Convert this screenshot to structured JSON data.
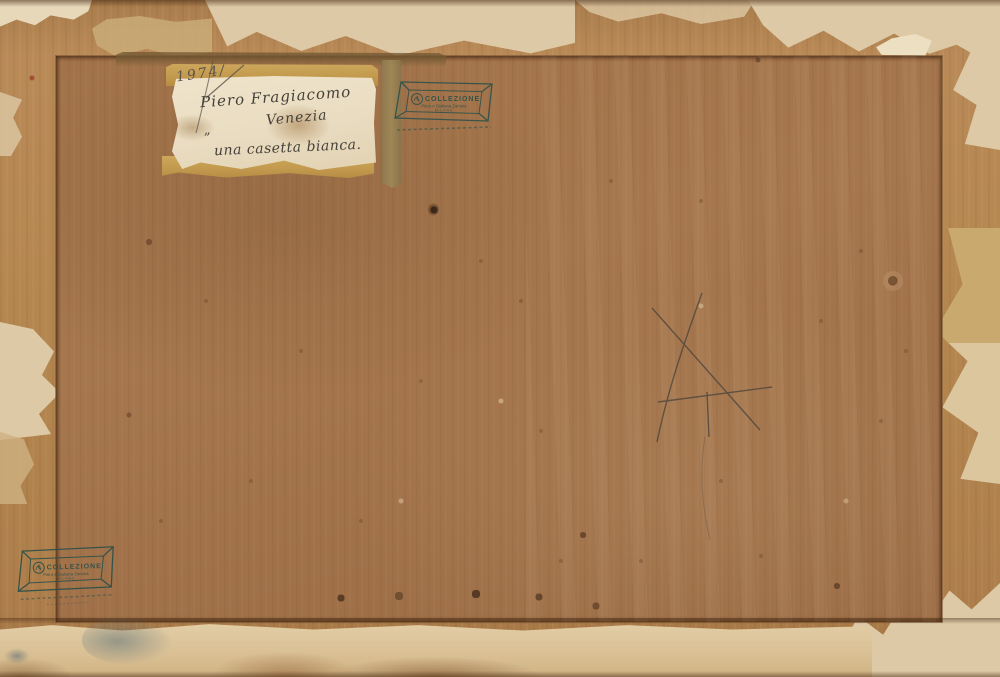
{
  "label": {
    "inventory_number": "1974/",
    "artist": "Piero Fragiacomo",
    "place": "Venezia",
    "open_quote": "”",
    "title": "una casetta bianca."
  },
  "stamp": {
    "line1": "COLLEZIONE",
    "line2": "Piero e Giuliana Zanona",
    "line3": "MILANO"
  },
  "colors": {
    "panel_brown": "#a2734a",
    "margin_wood": "#b4864f",
    "paper_cream": "#ddc9a5",
    "tape_ochre": "#c39a4e",
    "label_cream": "#e9dcc1",
    "ink_dark": "#45413a",
    "stamp_teal": "#2c5049",
    "pencil_gray": "#5b544b"
  }
}
